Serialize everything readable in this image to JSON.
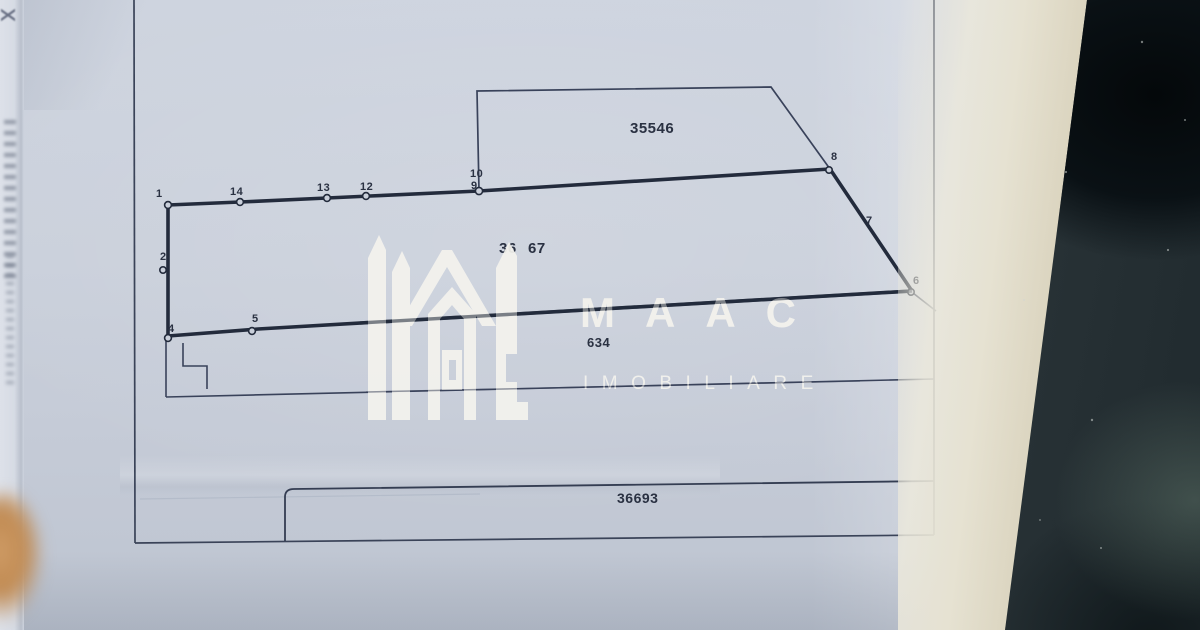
{
  "watermark": {
    "brand": "MAAC",
    "subtitle": "IMOBILIARE"
  },
  "plan": {
    "parcel_labels": [
      {
        "name": "parcel-label-35546",
        "text": "35546",
        "x": 630,
        "y": 121,
        "size": 15
      },
      {
        "name": "parcel-label-36x67-left",
        "text": "36",
        "x": 499,
        "y": 241,
        "size": 15
      },
      {
        "name": "parcel-label-36x67-right",
        "text": "67",
        "x": 528,
        "y": 241,
        "size": 15
      },
      {
        "name": "parcel-label-634",
        "text": "634",
        "x": 587,
        "y": 336,
        "size": 13
      },
      {
        "name": "parcel-label-36693",
        "text": "36693",
        "x": 617,
        "y": 491,
        "size": 14
      }
    ],
    "vertex_labels": [
      {
        "text": "1",
        "x": 156,
        "y": 189
      },
      {
        "text": "14",
        "x": 230,
        "y": 187
      },
      {
        "text": "13",
        "x": 317,
        "y": 183
      },
      {
        "text": "12",
        "x": 360,
        "y": 182
      },
      {
        "text": "10",
        "x": 470,
        "y": 169
      },
      {
        "text": "9",
        "x": 471,
        "y": 181
      },
      {
        "text": "8",
        "x": 831,
        "y": 152
      },
      {
        "text": "7",
        "x": 866,
        "y": 216
      },
      {
        "text": "6",
        "x": 913,
        "y": 276
      },
      {
        "text": "5",
        "x": 252,
        "y": 314
      },
      {
        "text": "4",
        "x": 168,
        "y": 324
      },
      {
        "text": "2",
        "x": 160,
        "y": 252
      }
    ]
  },
  "colors": {
    "paper": "#c9cfda",
    "ink": "#232b3c",
    "thin_ink": "#39425a",
    "watermark_white": "#f4f3ee",
    "paper_edge_cream": "#d9d2bc",
    "background_dark": "#242e32",
    "finger": "#c08a52"
  }
}
